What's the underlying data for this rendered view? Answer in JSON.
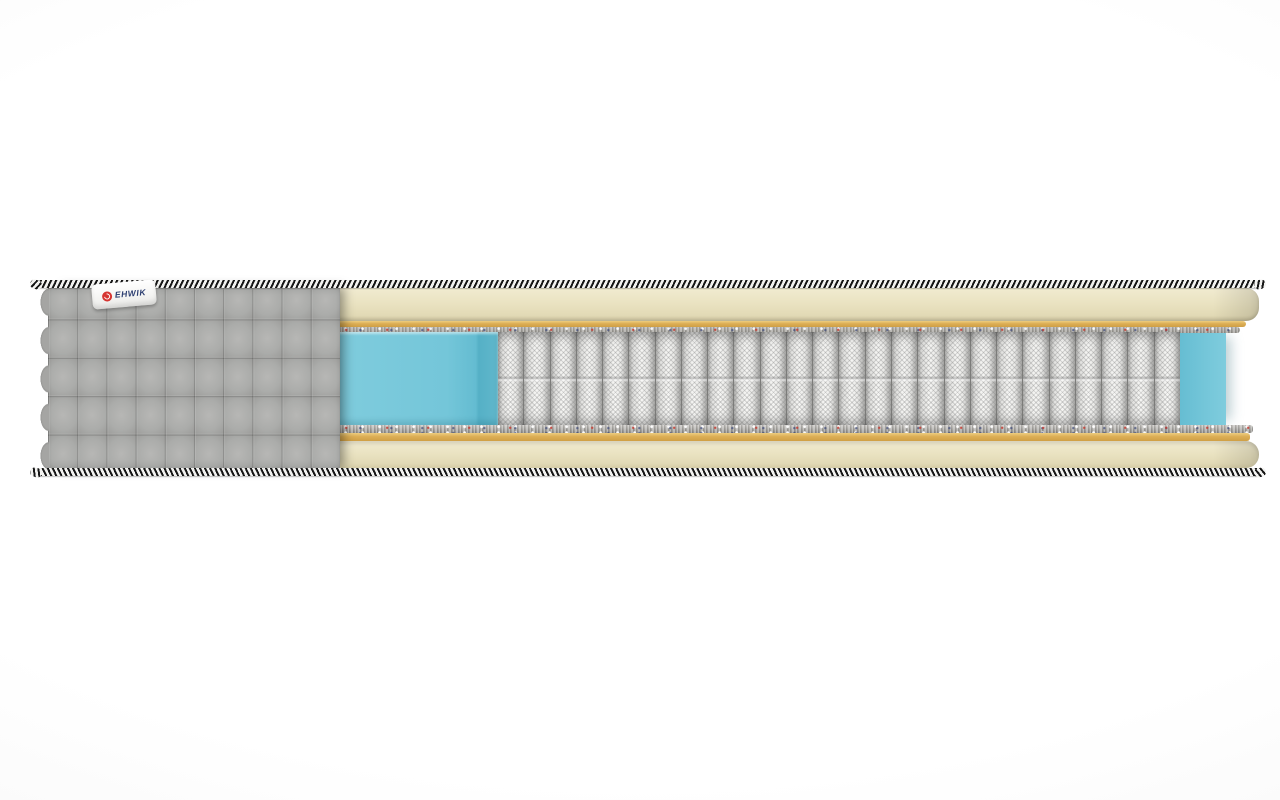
{
  "scene": {
    "subject": "mattress cross-section cutaway render",
    "materials": [
      "quilted-cover",
      "striped-border-tape",
      "comfort-foam",
      "fiber-pad",
      "felt-pad",
      "perimeter-foam",
      "pocket-springs"
    ]
  },
  "brand_tag": {
    "text": "EHWIK"
  },
  "cover": {
    "quilt_rows": 5,
    "quilt_columns": 10
  },
  "springs": {
    "count": 26,
    "type": "pocket-coil"
  },
  "colors": {
    "background": "#ffffff",
    "cover-gray": "#a7a7a5",
    "cream": "#eae3c2",
    "tan": "#cf9f45",
    "felt": "#a4a29e",
    "teal": "#74c6d9",
    "teal-deep": "#55b0c6",
    "coil": "#ededeb",
    "stripe-dark": "#161616",
    "stripe-light": "#f3f3f1",
    "tag-red": "#d63531",
    "tag-navy": "#2c3e70"
  }
}
